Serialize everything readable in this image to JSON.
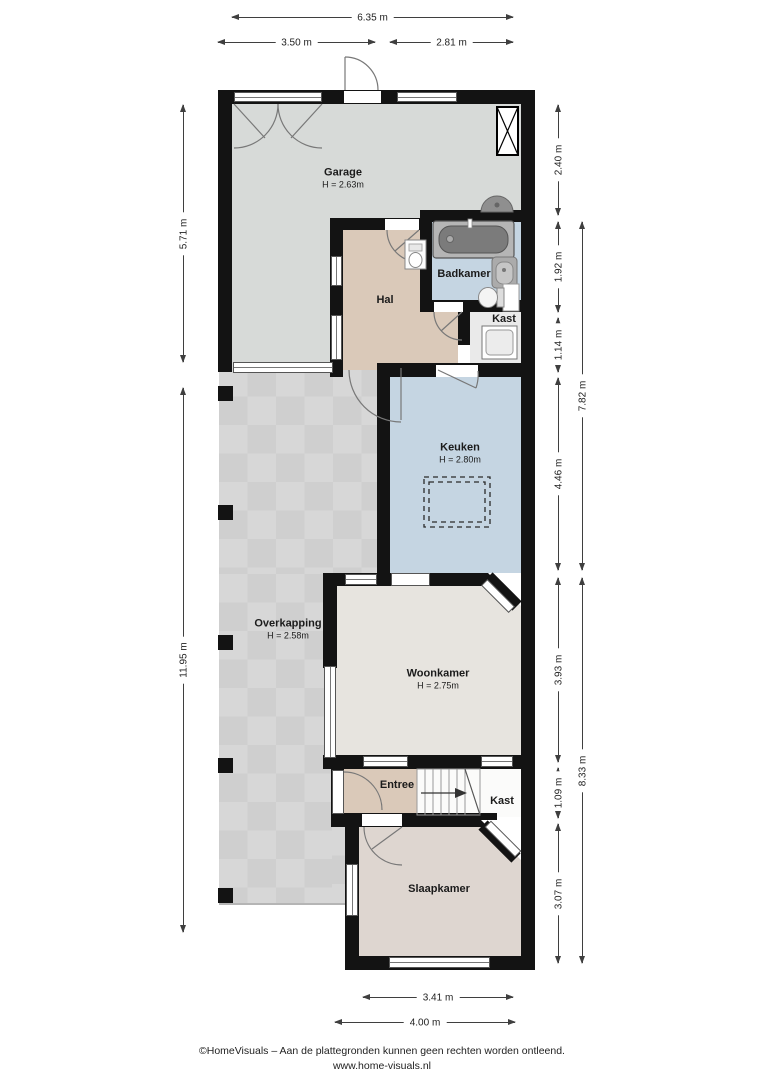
{
  "rooms": {
    "garage": {
      "label": "Garage",
      "height": "H = 2.63m"
    },
    "hal": {
      "label": "Hal"
    },
    "badkamer": {
      "label": "Badkamer"
    },
    "kast_boven": {
      "label": "Kast"
    },
    "keuken": {
      "label": "Keuken",
      "height": "H = 2.80m"
    },
    "overkapping": {
      "label": "Overkapping",
      "height": "H = 2.58m"
    },
    "woonkamer": {
      "label": "Woonkamer",
      "height": "H = 2.75m"
    },
    "entree": {
      "label": "Entree"
    },
    "kast_onder": {
      "label": "Kast"
    },
    "slaapkamer": {
      "label": "Slaapkamer"
    }
  },
  "dimensions": {
    "top": {
      "total": "6.35 m",
      "left_part": "3.50 m",
      "right_part": "2.81 m"
    },
    "left": {
      "garage": "5.71 m",
      "overkapping": "11.95 m"
    },
    "right": {
      "r1": "2.40 m",
      "r2": "1.92 m",
      "r3": "1.14 m",
      "r4": "4.46 m",
      "r5": "3.93 m",
      "r6": "1.09 m",
      "r7": "3.07 m",
      "span_upper": "7.82 m",
      "span_lower": "8.33 m"
    },
    "bottom": {
      "inner": "3.41 m",
      "outer": "4.00 m"
    }
  },
  "footer": {
    "line1": "©HomeVisuals – Aan de plattegronden kunnen geen rechten worden ontleend.",
    "line2": "www.home-visuals.nl"
  },
  "colors": {
    "wall": "#131313",
    "garage_floor": "#d7dad8",
    "hal_floor": "#dac9b9",
    "bath_kitchen_floor": "#c5d5e2",
    "living_floor": "#e7e4df",
    "bedroom_floor": "#ded6d0",
    "terrace_floor": "#d3d3d3",
    "closet_floor": "#eaeaea",
    "dimension_line": "#3f3f3f"
  }
}
